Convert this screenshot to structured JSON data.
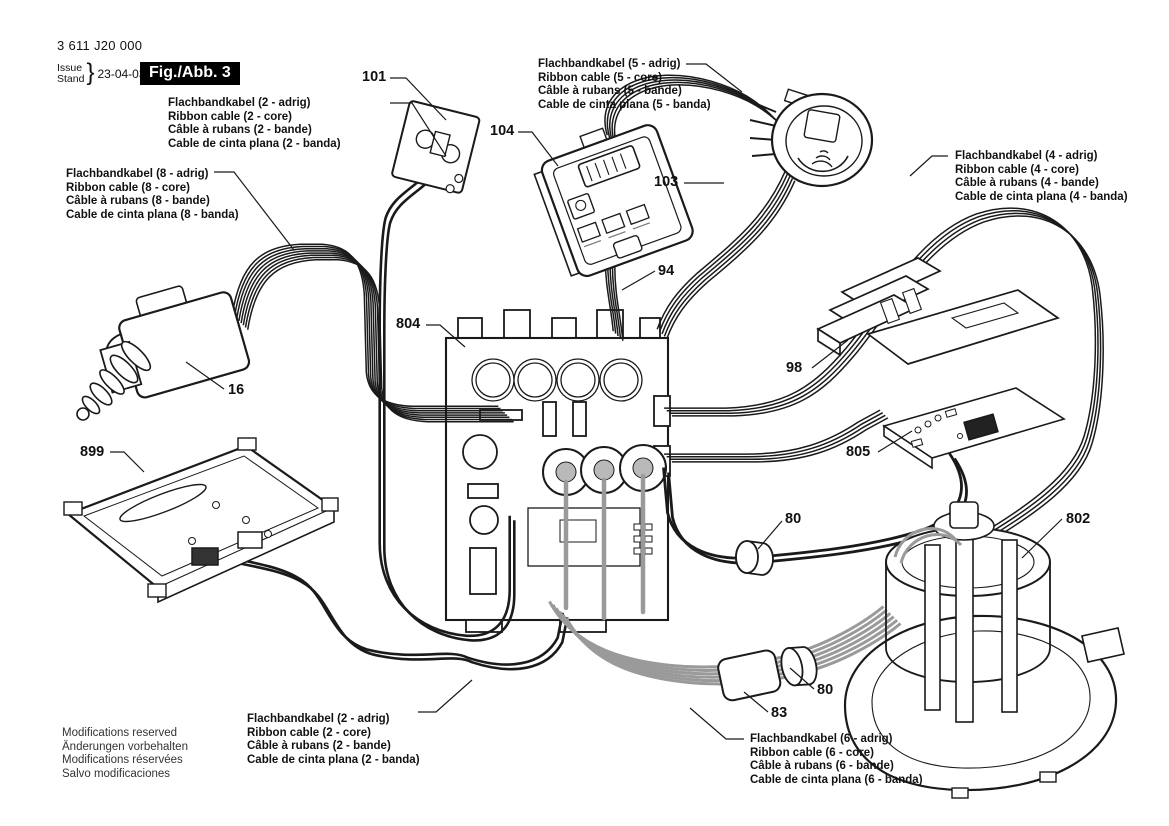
{
  "meta": {
    "part_number": "3 611 J20 000",
    "issue_label": "Issue",
    "stand_label": "Stand",
    "brace": "}",
    "date": "23-04-03",
    "figure_label": "Fig./Abb. 3"
  },
  "cable_labels": {
    "c2_top": {
      "de": "Flachbandkabel (2 - adrig)",
      "en": "Ribbon cable (2 - core)",
      "fr": "Câble à rubans (2 - bande)",
      "es": "Cable de cinta plana (2 - banda)"
    },
    "c5": {
      "de": "Flachbandkabel (5 - adrig)",
      "en": "Ribbon cable (5 - core)",
      "fr": "Câble à rubans (5 - bande)",
      "es": "Cable de cinta plana (5 - banda)"
    },
    "c8": {
      "de": "Flachbandkabel (8 - adrig)",
      "en": "Ribbon cable (8 - core)",
      "fr": "Câble à rubans (8 - bande)",
      "es": "Cable de cinta plana (8 - banda)"
    },
    "c4": {
      "de": "Flachbandkabel (4 - adrig)",
      "en": "Ribbon cable (4 - core)",
      "fr": "Câble à rubans (4 - bande)",
      "es": "Cable de cinta plana (4 - banda)"
    },
    "c2_bottom": {
      "de": "Flachbandkabel (2 - adrig)",
      "en": "Ribbon cable (2 - core)",
      "fr": "Câble à rubans (2 - bande)",
      "es": "Cable de cinta plana (2 - banda)"
    },
    "c6": {
      "de": "Flachbandkabel (6 - adrig)",
      "en": "Ribbon cable (6 - core)",
      "fr": "Câble à rubans (6 - bande)",
      "es": "Cable de cinta plana (6 - banda)"
    }
  },
  "callouts": {
    "n101": "101",
    "n104": "104",
    "n103": "103",
    "n94": "94",
    "n804": "804",
    "n16": "16",
    "n899": "899",
    "n98": "98",
    "n805": "805",
    "n80a": "80",
    "n802": "802",
    "n80b": "80",
    "n83": "83"
  },
  "footer": {
    "en": "Modifications reserved",
    "de": "Änderungen vorbehalten",
    "fr": "Modifications réservées",
    "es": "Salvo modificaciones"
  },
  "colors": {
    "ink": "#1a1a1a",
    "cable_gray": "#9a9a9a",
    "figure_bg": "#000000",
    "figure_fg": "#ffffff"
  }
}
